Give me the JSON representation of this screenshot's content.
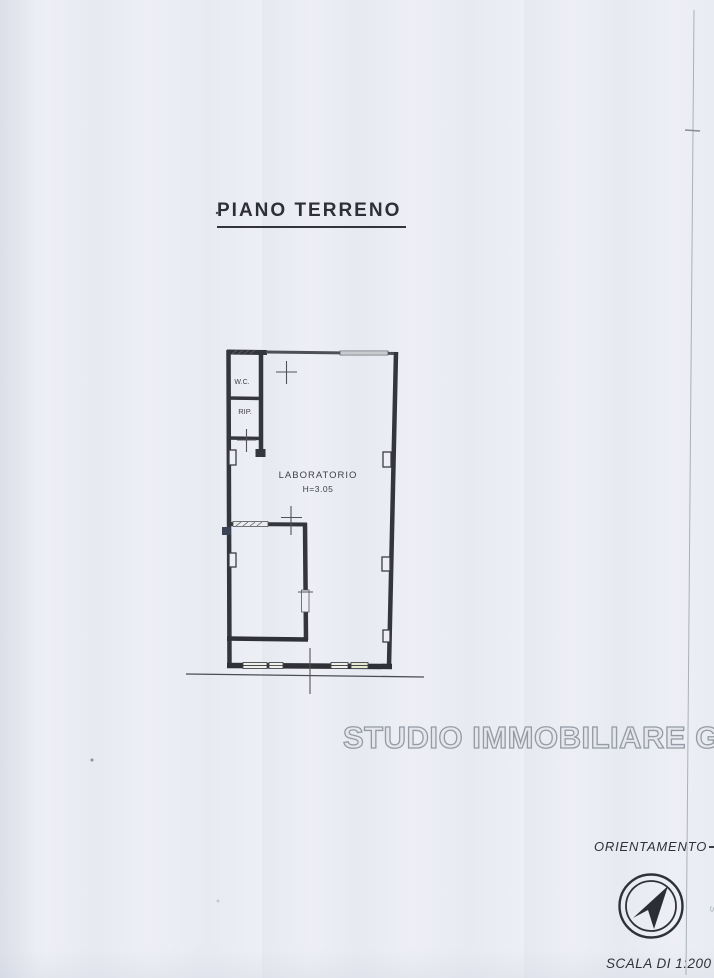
{
  "page": {
    "title": "PIANO TERRENO",
    "watermark": "STUDIO IMMOBILIARE GM"
  },
  "floorplan": {
    "rooms": [
      {
        "label": "W.C."
      },
      {
        "label": "RIP."
      },
      {
        "label": "LABORATORIO",
        "height_note": "H=3.05"
      }
    ]
  },
  "compass": {
    "label": "ORIENTAMENTO",
    "scale_label": "SCALA DI 1:200"
  },
  "colors": {
    "ink": "#3a3c42",
    "paper": "#edeff5",
    "watermark_stroke": "#959aa4"
  }
}
